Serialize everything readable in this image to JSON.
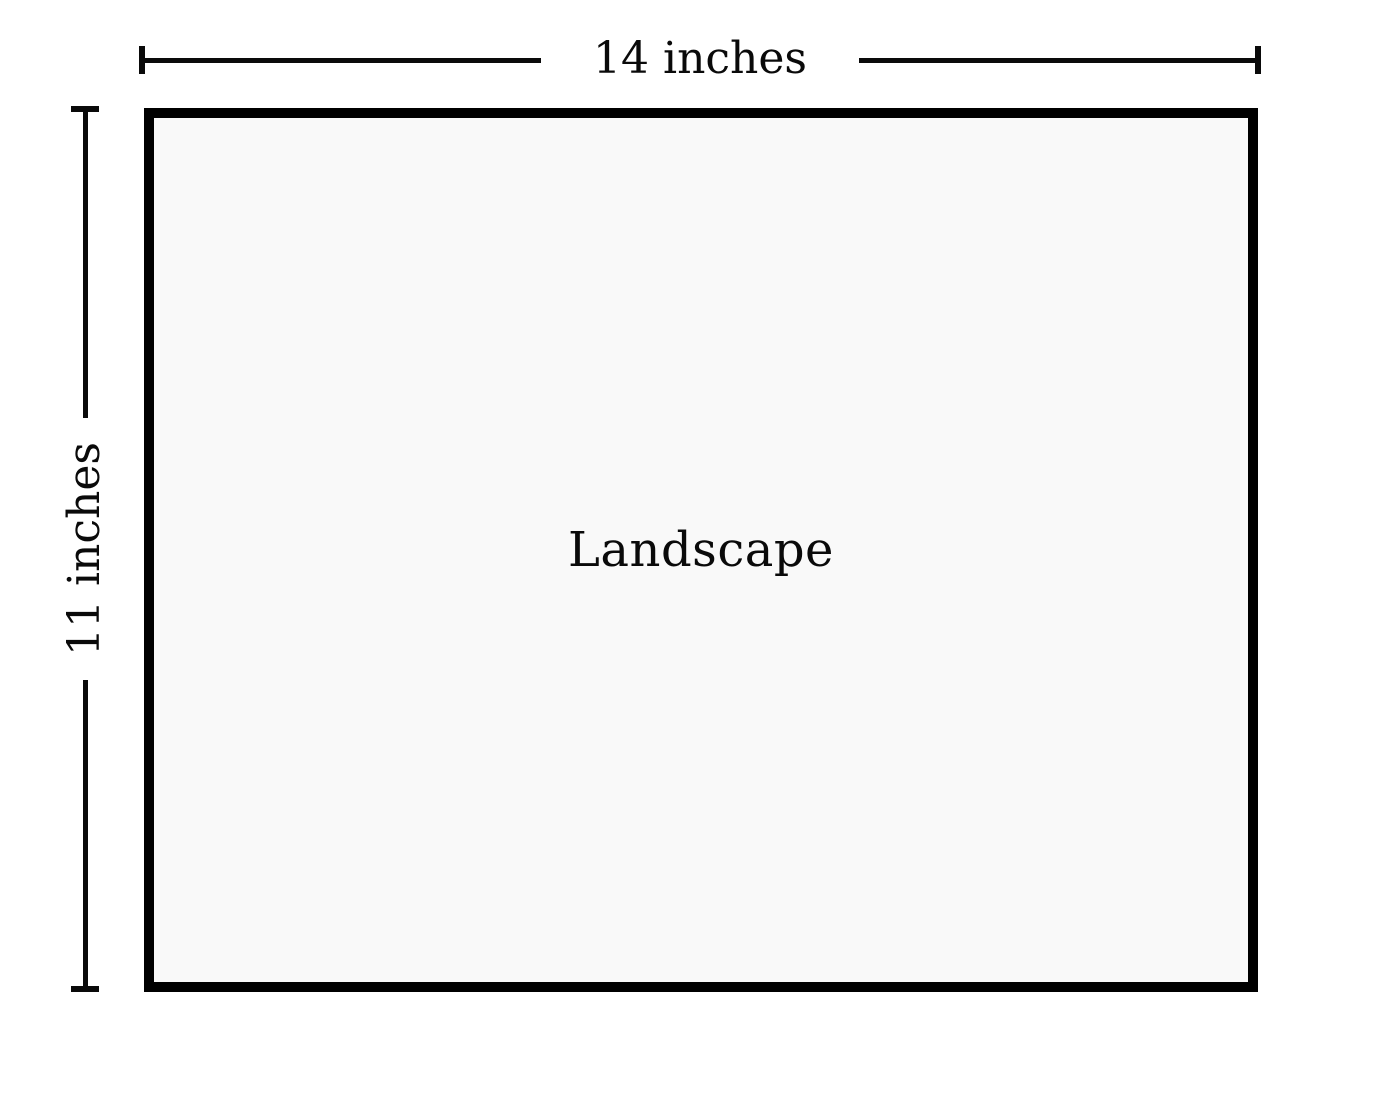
{
  "diagram": {
    "shape": {
      "label": "Landscape"
    },
    "dimensions": {
      "width": {
        "label": "14 inches"
      },
      "height": {
        "label": "11 inches"
      }
    },
    "colors": {
      "border": "#000000",
      "fill": "#f9f9f9",
      "line": "#0a0a0a",
      "text": "#0a0a0a",
      "background": "#ffffff"
    }
  }
}
